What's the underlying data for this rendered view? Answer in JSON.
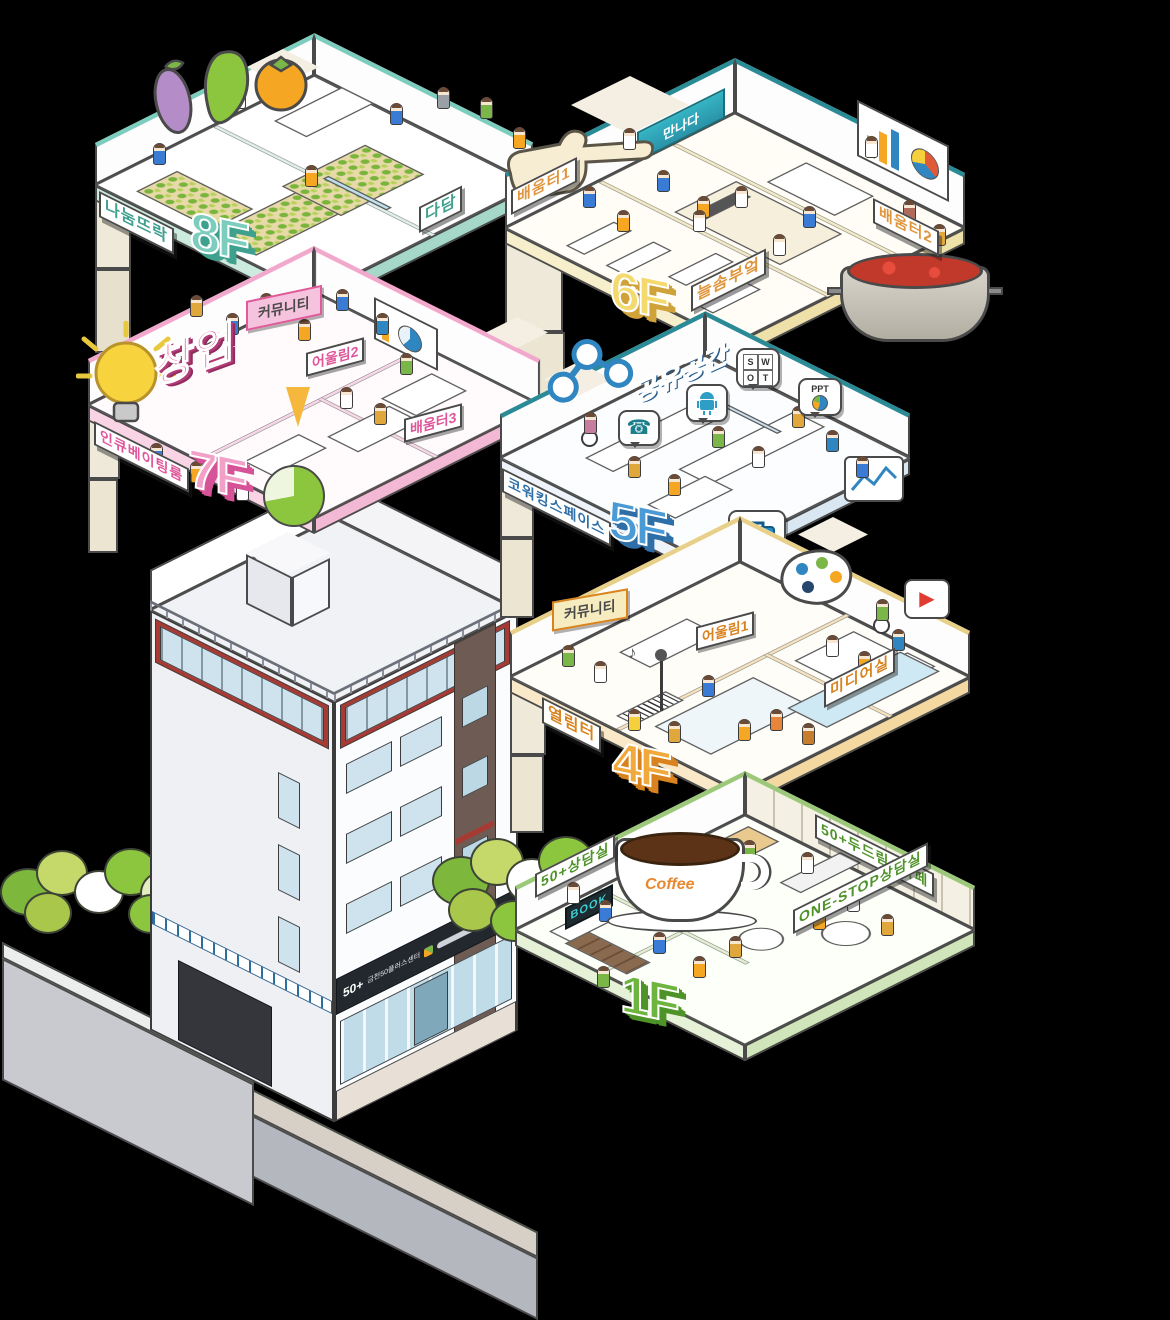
{
  "scene": {
    "background": "#000000",
    "outline_color": "#4a4a4a"
  },
  "glyphs": {
    "play": "▶",
    "phone": "☎",
    "music_note": "♪"
  },
  "floors": {
    "f8": {
      "number": "8F",
      "accent": "#7ccdbd",
      "accent_dark": "#3fa08e",
      "label_left": "나눔뜨락",
      "label_right": "다담",
      "icons": [
        "eggplant-icon",
        "kale-leaf-icon",
        "persimmon-icon",
        "garden-bed",
        "elevator"
      ]
    },
    "f6": {
      "number": "6F",
      "accent": "#f3d96e",
      "accent_dark": "#cfa23a",
      "label_color": "#e0953c",
      "label_left": "배움터1",
      "label_right": "배움터2",
      "label_front": "늘솜부엌",
      "board_text": "만나다",
      "icons": [
        "pointing-hand-icon",
        "soup-pot-icon",
        "presentation-screen-icon",
        "elevator"
      ]
    },
    "f7": {
      "number": "7F",
      "accent": "#f2a0c8",
      "accent_dark": "#d65397",
      "big_label": "창업",
      "banner": "커뮤니티",
      "label_left": "인큐베이팅룸",
      "room_a": "어울림2",
      "room_b": "배움터3",
      "icons": [
        "lightbulb-icon",
        "pie-chart-icon",
        "pennant-icon"
      ]
    },
    "f5": {
      "number": "5F",
      "accent": "#4a9bd5",
      "accent_dark": "#2e6fa8",
      "big_label": "공유공간",
      "label_left": "코워킹스페이스",
      "swot": [
        "S",
        "W",
        "O",
        "T"
      ],
      "ppt_label": "PPT",
      "icons": [
        "share-icon",
        "phone-icon",
        "android-icon",
        "swot-bubble",
        "ppt-bubble",
        "briefcase-icon",
        "line-chart-icon",
        "wheelchair-icon"
      ]
    },
    "f4": {
      "number": "4F",
      "accent": "#f2a93b",
      "accent_dark": "#d9831f",
      "banner": "커뮤니티",
      "room": "어울림1",
      "label_left": "열림터",
      "label_right": "미디어실",
      "icons": [
        "palette-icon",
        "play-button-icon",
        "microphone-icon",
        "keyboard-icon",
        "wheelchair-icon"
      ]
    },
    "f1": {
      "number": "1F",
      "accent": "#6db53f",
      "accent_dark": "#4e9328",
      "label_back_left": "50+상담실",
      "label_back_right": "50+두드림&카페",
      "label_front": "ONE-STOP상담실",
      "book_sign": "BOOK",
      "coffee_text": "Coffee",
      "icons": [
        "coffee-cup-icon",
        "book-sign-icon",
        "trees"
      ]
    }
  },
  "building": {
    "sign_logo": "50+",
    "sign_name": "금천50플러스센터"
  }
}
